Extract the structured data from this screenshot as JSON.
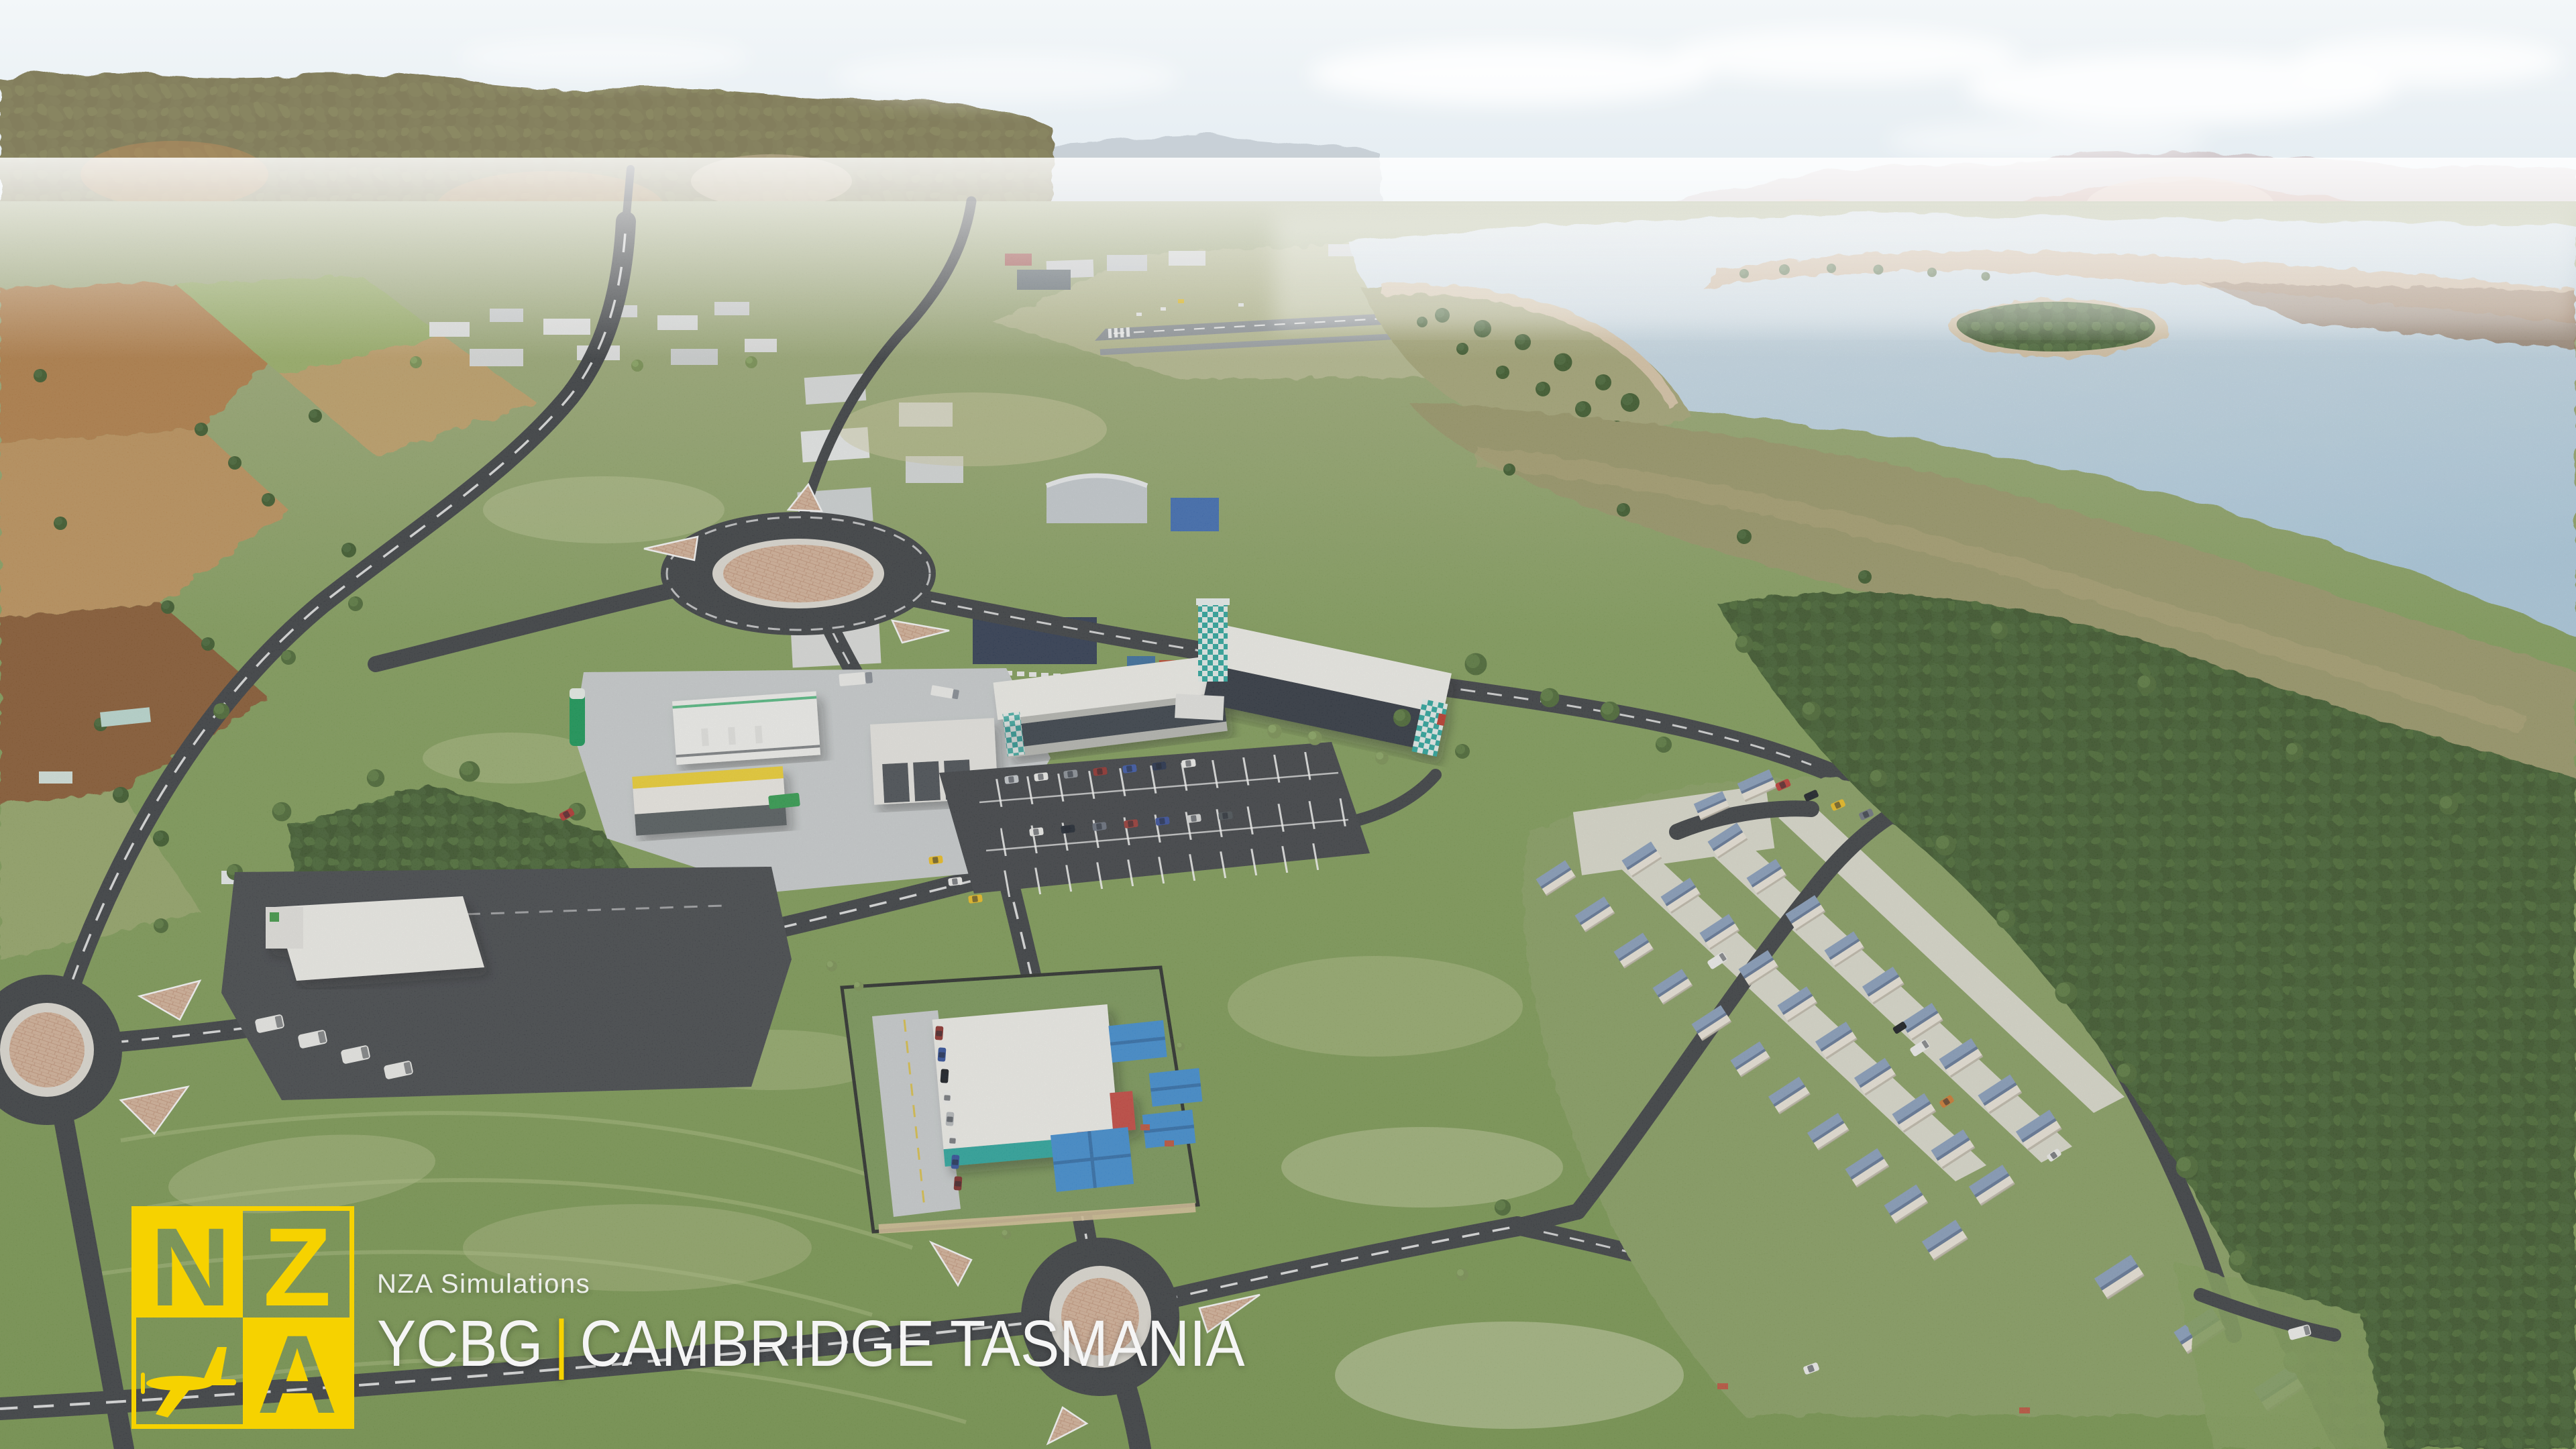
{
  "overlay": {
    "brand": "NZA Simulations",
    "icao": "YCBG",
    "separator": "|",
    "location": "CAMBRIDGE TASMANIA",
    "logo": {
      "letter_n": "N",
      "letter_z": "Z",
      "letter_a": "A"
    }
  },
  "scene": {
    "rooftop_text": "EYE SPY GO DIPS"
  },
  "colors": {
    "logo_yellow": "#F6D200",
    "text_white": "#F5F5F5",
    "sky_top": "#f3f7f9",
    "sky_horizon": "#e1eaf0",
    "hills_left": "#b49a80",
    "hills_pink": "#c9a9a1",
    "hills_far": "#c5cdd4",
    "water_far": "#dde9f1",
    "water_near": "#aecde2",
    "sand": "#cfb495",
    "mud": "#8f6e52",
    "grass_far": "#adb489",
    "grass_mid": "#84a05c",
    "grass_near": "#78974f",
    "field_tan": "#b58049",
    "field_gold": "#c0945c",
    "field_brown": "#8a5a33",
    "forest": "#41602f",
    "marsh": "#9c9a6b",
    "road": "#3b3e43",
    "marking": "#ffffff",
    "pavement": "#cdd1d3",
    "brick": "#d8b69c",
    "roof_white": "#f4f3ef",
    "glass_dark": "#2d3540",
    "teal": "#2ba8a0",
    "canopy_blue": "#3f8ed5",
    "red_accent": "#c8473f",
    "cabin_roof": "#8aa0bf",
    "store_yellow": "#f2d433",
    "sign_green": "#169a58",
    "runway_gray": "#8e9499"
  }
}
